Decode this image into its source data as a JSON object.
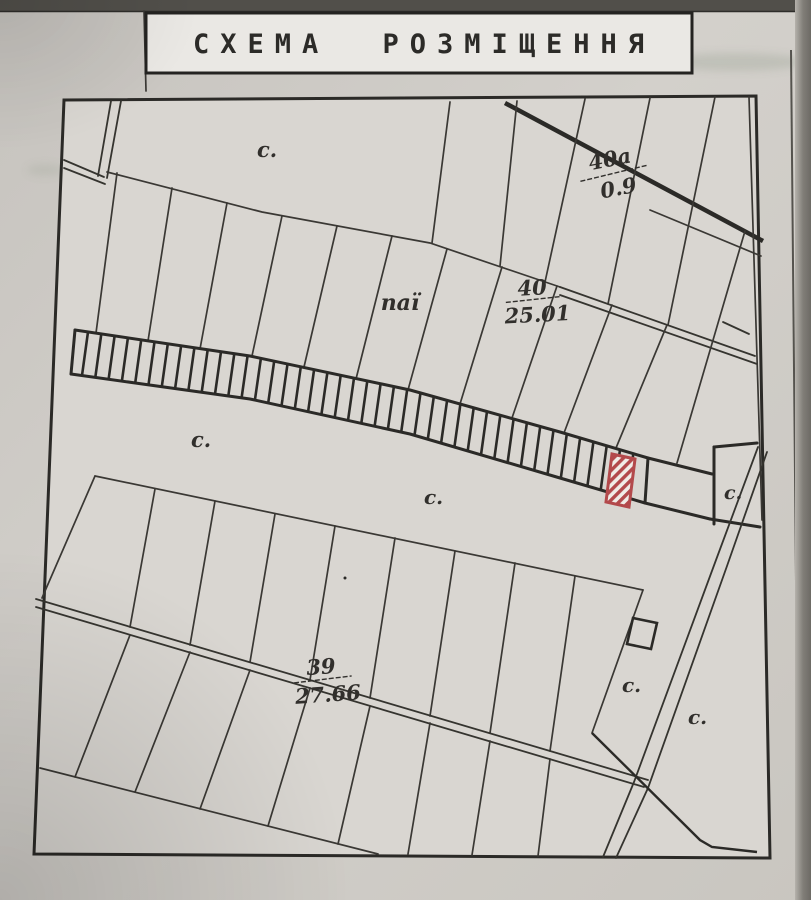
{
  "title": "СХЕМА РОЗМІЩЕННЯ",
  "legend": {
    "pasture_symbol": "с."
  },
  "parcels": {
    "top_right": {
      "number": "40а",
      "area": "0.9"
    },
    "center": {
      "label": "паї",
      "number": "40",
      "area": "25.01"
    },
    "bottom": {
      "number": "39",
      "area": "27.66"
    }
  },
  "highlight": {
    "color": "#b3494b",
    "meaning": "selected-allotment-strip"
  },
  "colors": {
    "paper": "#d9d6d1",
    "ink": "#2b2a27"
  }
}
